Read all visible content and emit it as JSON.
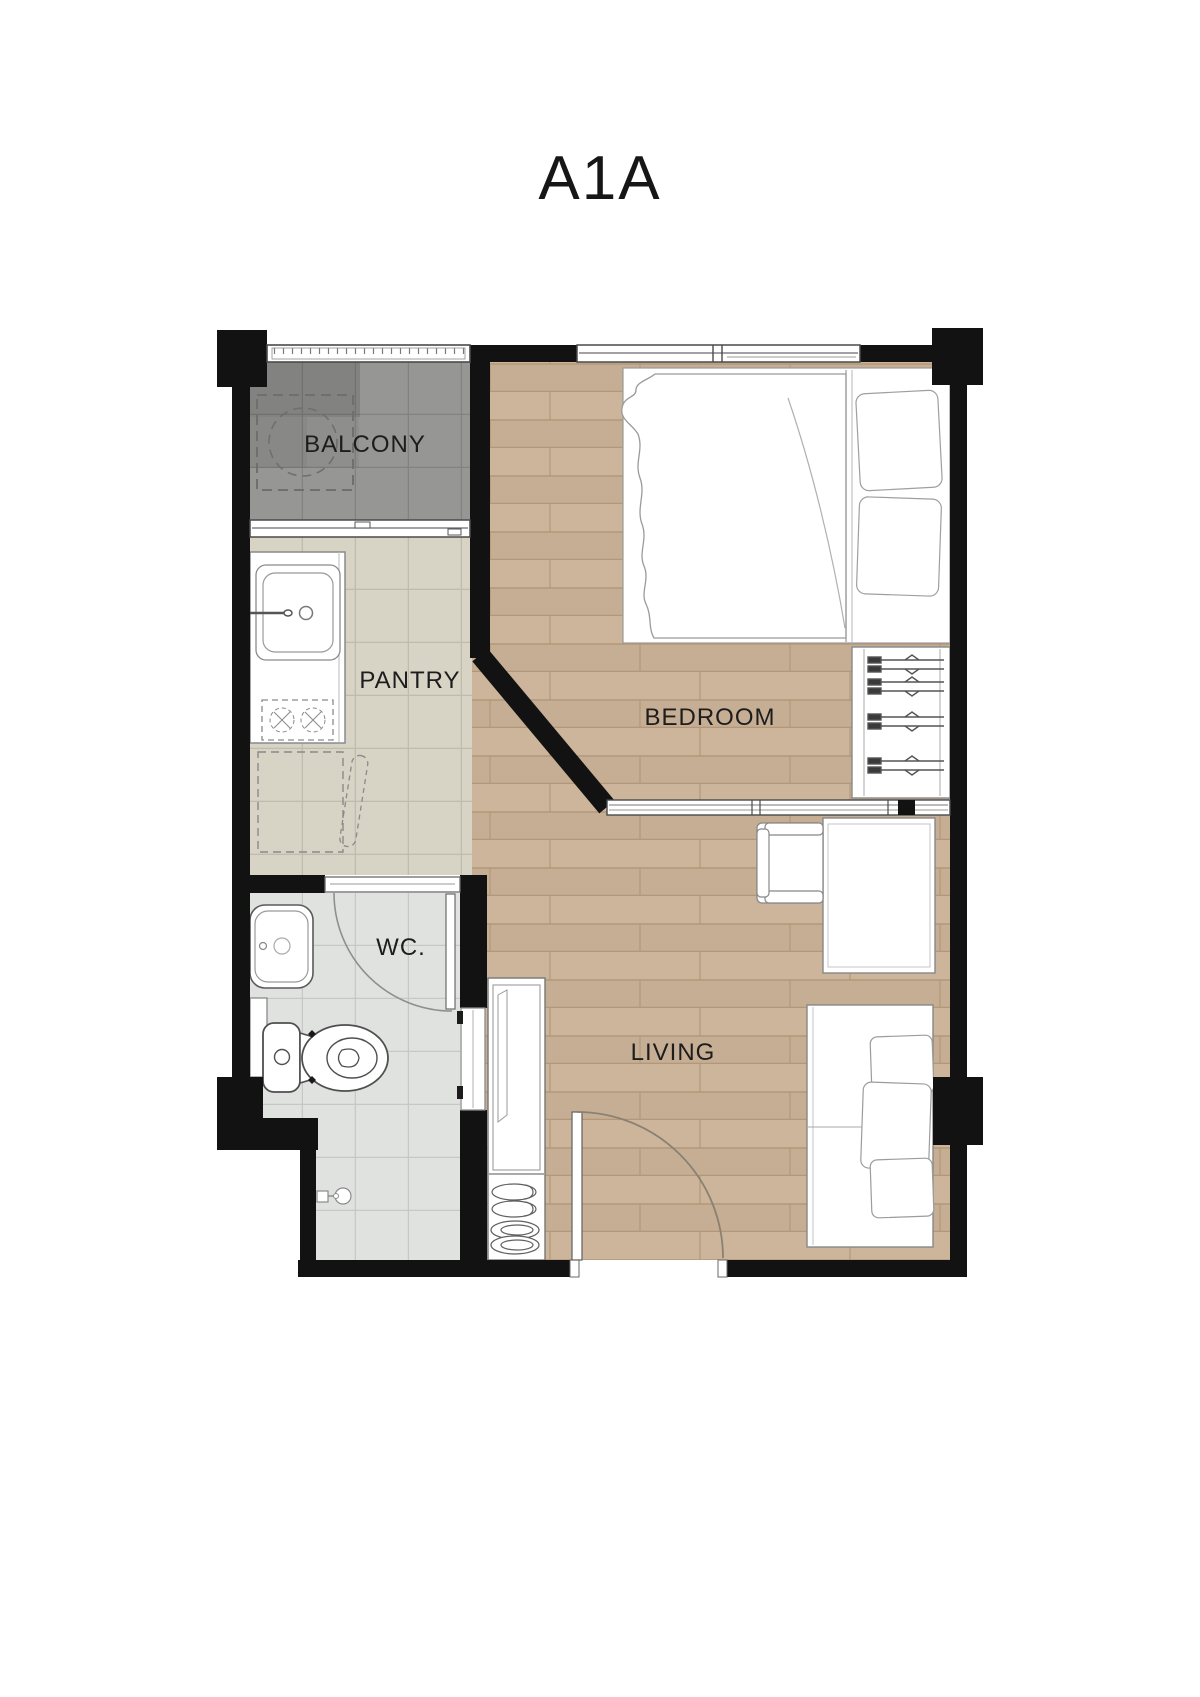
{
  "title": "A1A",
  "rooms": {
    "balcony": {
      "label": "BALCONY"
    },
    "pantry": {
      "label": "PANTRY"
    },
    "bedroom": {
      "label": "BEDROOM"
    },
    "wc": {
      "label": "WC."
    },
    "living": {
      "label": "LIVING"
    }
  },
  "colors": {
    "background": "#ffffff",
    "wall": "#121212",
    "wood_floor": "#cbb299",
    "pantry_tile": "#d7d3c5",
    "wc_tile": "#e0e2e0",
    "balcony_tile": "#969694",
    "furniture_outline": "#8a8a8a",
    "label_text": "#1d1d1d"
  }
}
